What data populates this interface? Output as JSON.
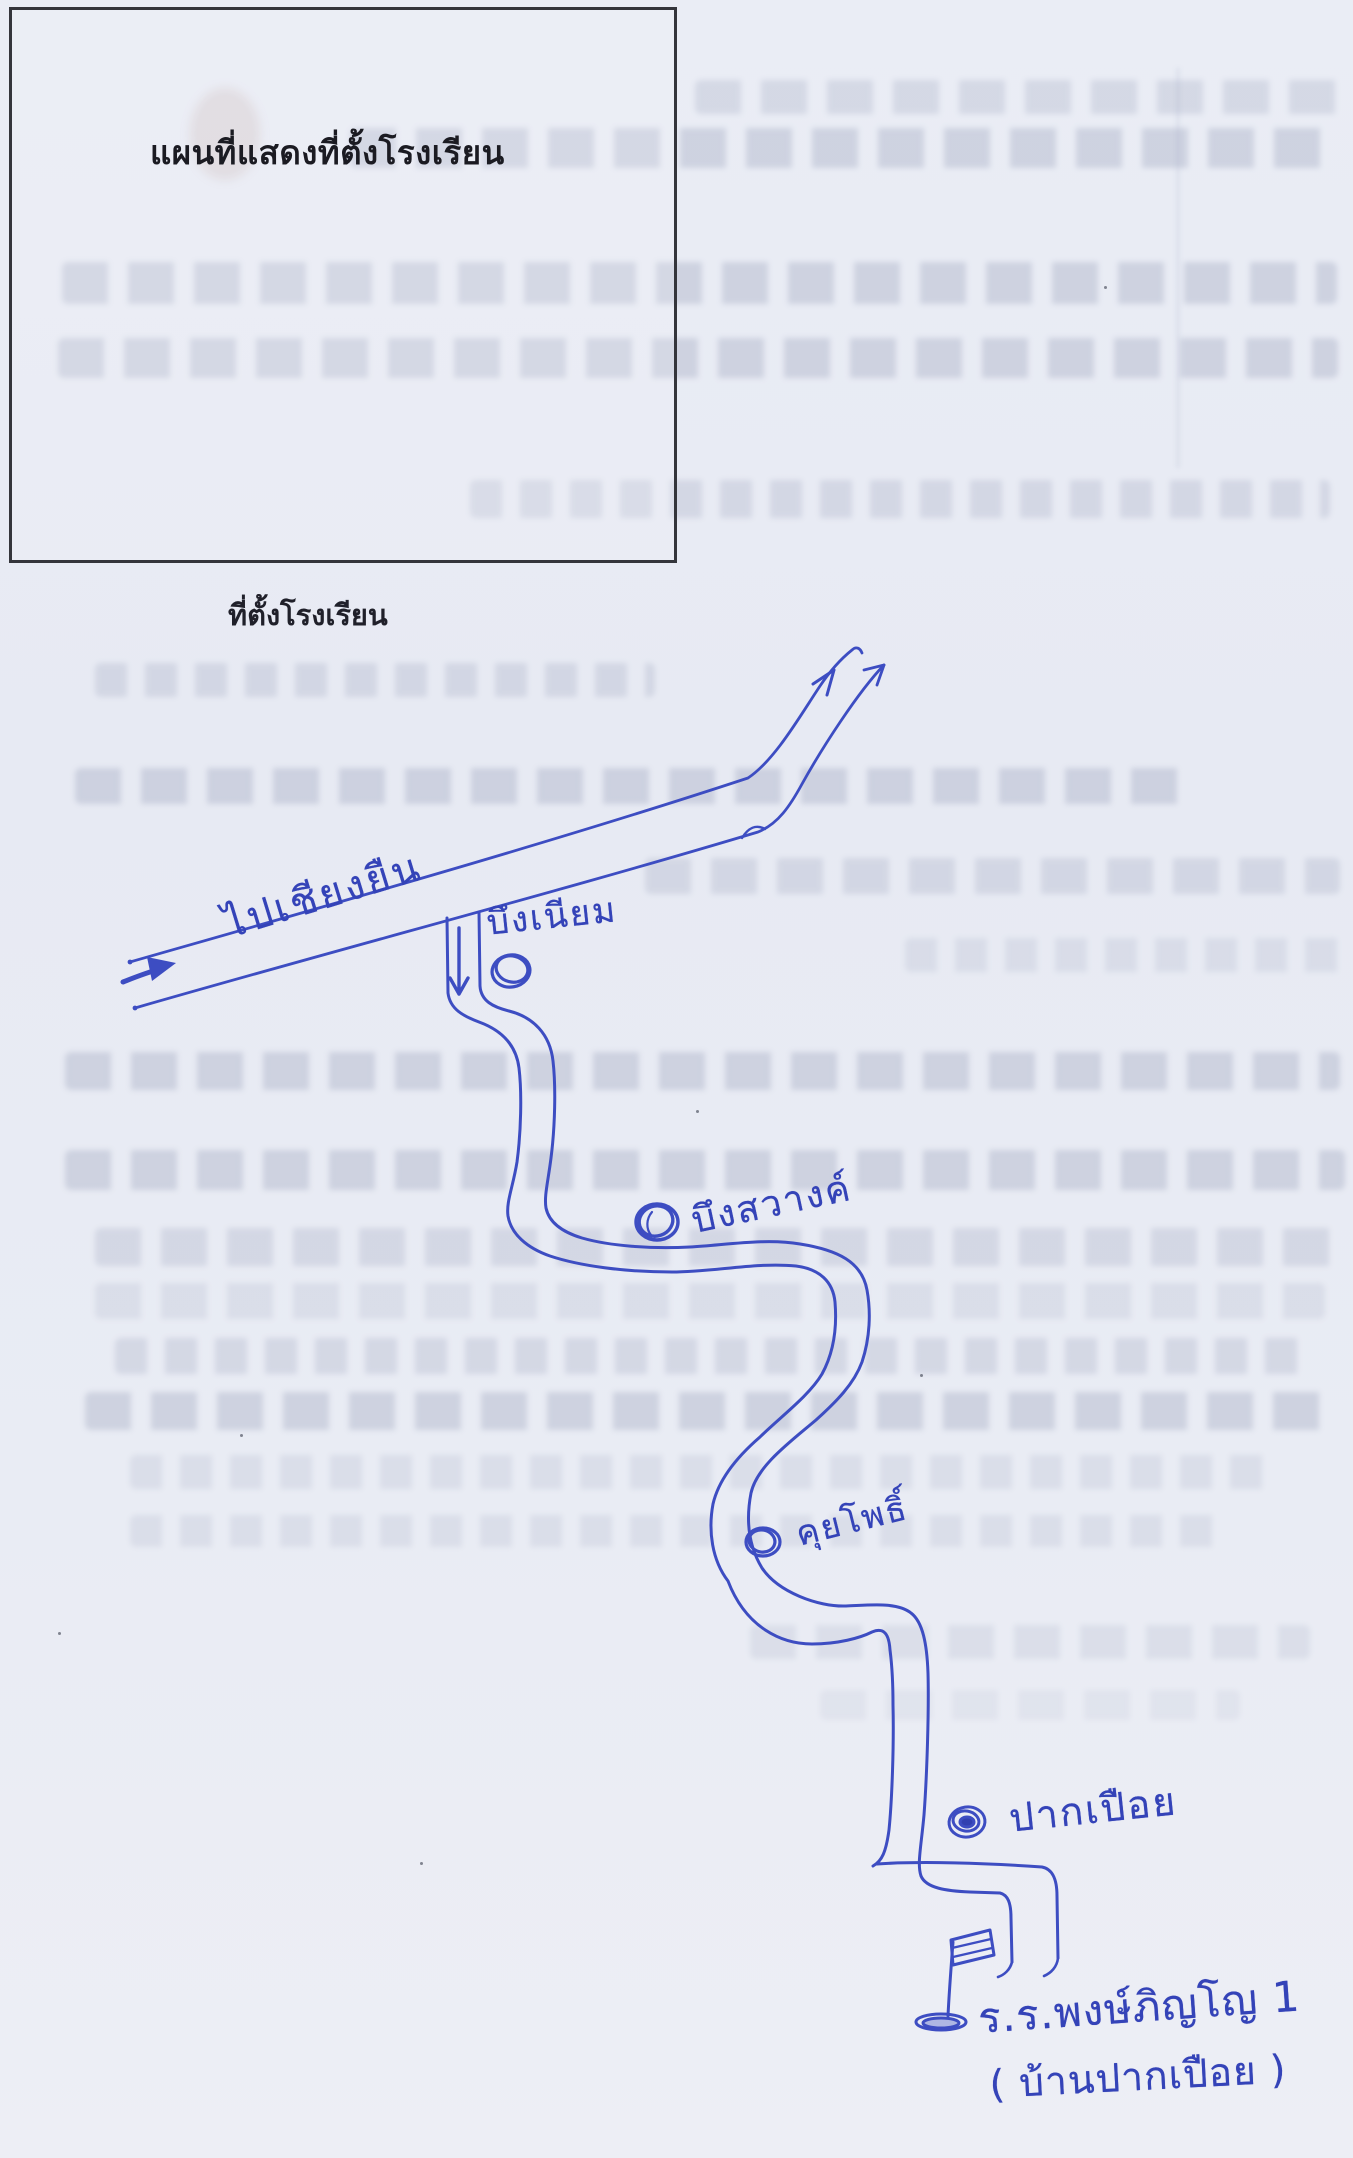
{
  "document": {
    "box_title": "แผนที่แสดงที่ตั้งโรงเรียน",
    "caption": "ที่ตั้งโรงเรียน"
  },
  "map": {
    "ink_color": "#3d4dc2",
    "road_direction_label": "ไปเชียงยืน",
    "places": [
      {
        "name": "บึงเนียม",
        "symbol": "village-circle"
      },
      {
        "name": "บึงสวางค์",
        "symbol": "village-circle"
      },
      {
        "name": "คุยโพธิ์",
        "symbol": "village-circle"
      },
      {
        "name": "ปากเปือย",
        "symbol": "village-circle"
      }
    ],
    "school": {
      "symbol": "flag",
      "name": "ร.ร.พงษ์ภิญโญ 1",
      "village": "( บ้านปากเปือย )"
    }
  }
}
